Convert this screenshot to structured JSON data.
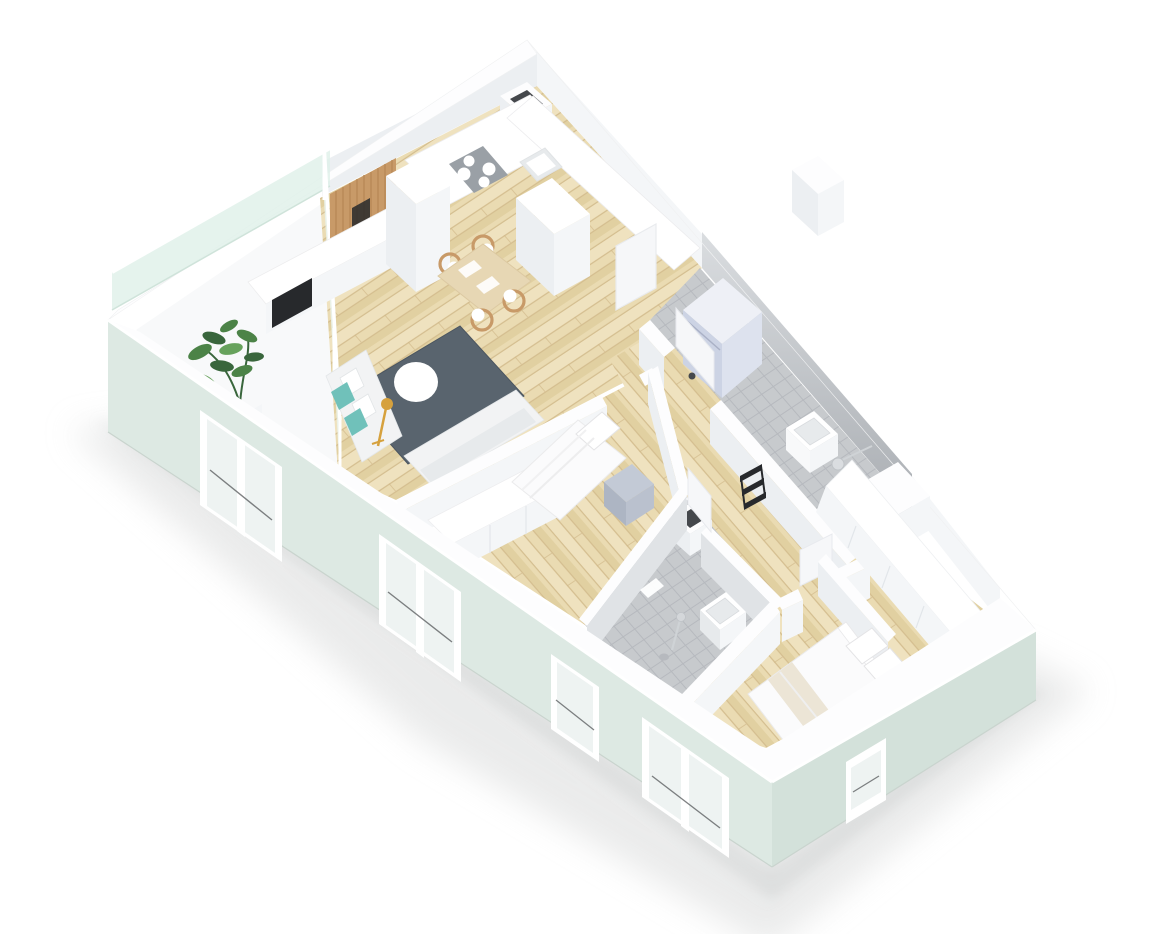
{
  "scene": {
    "title": "3D isometric floor plan rendering of a two-bedroom apartment",
    "style": "isometric-architectural-render",
    "background": "#ffffff"
  },
  "palette": {
    "bg": "#ffffff",
    "shadow": "#dadbdb",
    "shadowDark": "#cfd1d1",
    "wallTop": "#fdfdfe",
    "wallFaceLight": "#f4f6f8",
    "wallFaceMid": "#eceff2",
    "wallFaceDark": "#e4e8ec",
    "facade": "#dde9e3",
    "facadeDark": "#d3e1da",
    "facadeEdge": "#eef4f0",
    "glass": "#dff0e8",
    "glassWall": "#e9f2ed",
    "paneGlass": "#eef3f2",
    "sashLine": "#55585a",
    "woodBase": "#eadbb2",
    "woodStripe": "#e0ce9e",
    "woodSeam": "#d2bb8c",
    "woodPale": "#f0e4c2",
    "tileFloor": "#c7cacd",
    "tileLine": "#b6b9be",
    "tileWallLight": "#dadde0",
    "tileWallDark": "#aaaeb3",
    "tileInner": "#e0e3e6",
    "rug": "#59646e",
    "rugDark": "#4c5660",
    "white": "#ffffff",
    "offWhite": "#f8f9fa",
    "sofa": "#f2f3f4",
    "sofaShade": "#e7eaec",
    "teal": "#70c1ba",
    "gold": "#d6a13d",
    "plant": "#4c8347",
    "plantDark": "#39663c",
    "plantLight": "#67a25c",
    "stove": "#9aa0a6",
    "black": "#27292c",
    "washerFace": "#ccd3e4",
    "washerSide": "#dde2ee",
    "washerTop": "#eef0f6",
    "nightTop": "#c3cad6",
    "nightFront": "#adb5c3",
    "nightSide": "#bac1ce",
    "linen": "#fbfbfc",
    "linenEdge": "#e8e8e8",
    "beige": "#ece5d6",
    "chairWood": "#c89a68",
    "tableWood": "#e7d7b4",
    "tableEdge": "#dcc9a2",
    "doorLeaf": "#f6f7f9",
    "doorEdge": "#e8eaee",
    "duct": "#45484c",
    "basin": "#e7eaec",
    "basinEdge": "#d8dbde",
    "metal": "#cfd3d6"
  },
  "rooms": [
    {
      "id": "kitchen-living-room",
      "floor": "wood"
    },
    {
      "id": "bedroom-1",
      "floor": "wood"
    },
    {
      "id": "bedroom-2",
      "floor": "wood"
    },
    {
      "id": "bathroom-1",
      "floor": "grey-tile"
    },
    {
      "id": "bathroom-2",
      "floor": "grey-tile"
    },
    {
      "id": "hallway",
      "floor": "wood"
    },
    {
      "id": "balcony",
      "floor": "concrete"
    }
  ],
  "furniture": {
    "kitchen": [
      "counter-with-stove",
      "sink",
      "tall-cabinets",
      "wood-slat-accent-wall",
      "sideboard-with-tv"
    ],
    "living": [
      "grey-rug",
      "round-coffee-table",
      "corner-sofa",
      "teal-pillows",
      "floor-lamp",
      "dining-table",
      "dining-chairs"
    ],
    "bedroom1": [
      "single-bed",
      "wardrobe",
      "nightstand"
    ],
    "bedroom2": [
      "double-bed",
      "long-wardrobe",
      "partition-wall"
    ],
    "bathroom1": [
      "washing-machine",
      "sink",
      "shower-drain"
    ],
    "bathroom2": [
      "shower",
      "basin-ledge",
      "floor-drain"
    ],
    "balcony": [
      "potted-plant",
      "glass-balustrade"
    ]
  }
}
